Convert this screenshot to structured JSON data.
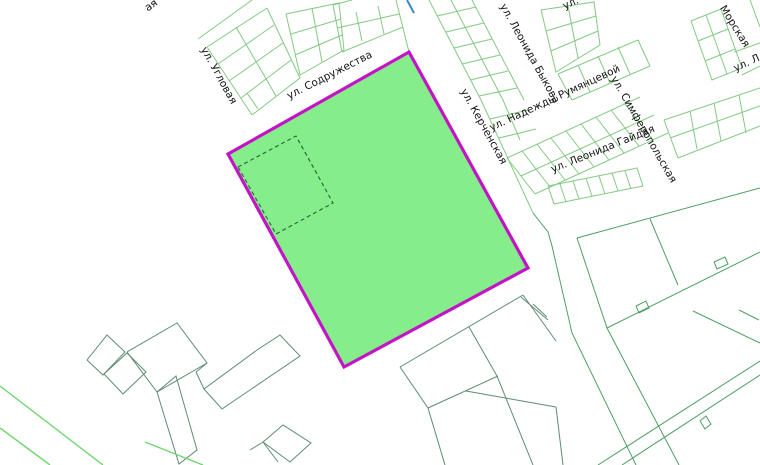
{
  "map": {
    "canvas": {
      "width": 760,
      "height": 465,
      "background": "#ffffff"
    },
    "colors": {
      "grid_light_green": "#83ca83",
      "parcel_mid_green": "#4d9f63",
      "outline_gray_green": "#5d8c72",
      "bright_green": "#6fd66f",
      "water_blue": "#3a86c8",
      "selected_fill": "#85ee8b",
      "selected_border": "#c412c6",
      "dashed_boundary": "#2d6a3f",
      "label_color": "#141414"
    },
    "selected_parcel": {
      "points": "228,154 409,52 528,268 344,367",
      "fill": "#85ee8b",
      "stroke": "#c412c6",
      "stroke_width": 3.2
    },
    "dashed_square": {
      "points": "238,167 296,136 333,203 276,234 238,167",
      "stroke": "#2d6a3f",
      "dash": "4,3"
    },
    "labels": [
      {
        "text": "ая",
        "x": 153,
        "y": 8,
        "rot": -35,
        "size": 10.5
      },
      {
        "text": "ул. Угловая",
        "x": 216,
        "y": 77,
        "rot": 61,
        "size": 10.5
      },
      {
        "text": "ул. Содружества",
        "x": 331,
        "y": 78,
        "rot": -27,
        "size": 10.5
      },
      {
        "text": "ул. Керченская",
        "x": 481,
        "y": 128,
        "rot": 61,
        "size": 10.5
      },
      {
        "text": "ул. Леонида Быкова",
        "x": 527,
        "y": 55,
        "rot": 61,
        "size": 10.5
      },
      {
        "text": "ул. Надежды Румянцевой",
        "x": 556,
        "y": 101,
        "rot": -25,
        "size": 10.5
      },
      {
        "text": "ул. Симферопольская",
        "x": 641,
        "y": 131,
        "rot": 60,
        "size": 10.5
      },
      {
        "text": "ул. Леонида Гайдая",
        "x": 604,
        "y": 152,
        "rot": -22,
        "size": 10.5
      },
      {
        "text": "Морская",
        "x": 732,
        "y": 28,
        "rot": 58,
        "size": 10.5
      },
      {
        "text": "ул. Л",
        "x": 748,
        "y": 66,
        "rot": -25,
        "size": 10.5
      },
      {
        "text": "ул.",
        "x": 572,
        "y": 6,
        "rot": -25,
        "size": 10.5
      }
    ],
    "layers": [
      {
        "name": "grid-light",
        "color": "#83ca83",
        "width": 1,
        "polylines": [
          "207,47 267,8",
          "207,47 252,115",
          "252,115 300,78",
          "267,8 300,78",
          "218,64 274,25",
          "229,81 283,43",
          "241,98 291,60",
          "236,27 276,96",
          "198,39 252,0",
          "247,93 258,109",
          "286,14 339,3 344,50 300,75 286,14",
          "312,8 322,62",
          "291,34 341,19",
          "295,55 342,35",
          "333,5 342,52",
          "342,52 403,27",
          "333,5 352,0",
          "337,28 399,14",
          "356,12 362,41",
          "378,6 384,34",
          "396,0 409,52",
          "429,0 481,100 533,213",
          "451,0 503,100 520,140",
          "472,0 524,100",
          "437,16 476,7",
          "446,32 484,23",
          "454,48 492,39",
          "462,64 500,55",
          "470,80 508,71",
          "479,96 517,88",
          "490,119 528,110",
          "499,138 536,129",
          "541,10 594,2 600,45 556,72 541,10",
          "568,6 578,58",
          "546,31 596,16",
          "551,51 598,31",
          "558,74 638,40",
          "572,100 650,66",
          "558,74 572,100",
          "638,40 650,66",
          "578,65 590,92",
          "598,56 610,83",
          "618,47 630,74",
          "691,21 721,9 742,68 712,80 691,21",
          "706,15 727,74",
          "698,41 728,29",
          "705,61 735,49",
          "750,0 760,27",
          "734,52 760,43",
          "742,75 760,66",
          "664,120 760,88",
          "670,138 760,106",
          "678,158 760,126",
          "664,120 678,158",
          "690,111 697,149",
          "714,103 721,141",
          "739,95 746,133",
          "507,158 640,97",
          "521,176 654,115",
          "535,194 668,133",
          "507,158 535,194",
          "522,151 550,187",
          "537,144 565,180",
          "551,138 579,174",
          "566,131 594,167",
          "581,124 609,160",
          "596,117 624,153",
          "611,110 639,146",
          "625,104 653,140",
          "548,186 637,168 643,186 554,204 548,186",
          "560,184 566,202",
          "573,181 579,199",
          "586,178 592,196",
          "599,176 605,194",
          "612,173 618,191",
          "625,171 631,189"
        ]
      },
      {
        "name": "parcel-mid",
        "color": "#4d9f63",
        "width": 1,
        "polylines": [
          "577,238 760,188",
          "577,238 607,328 679,465",
          "650,219 678,285",
          "607,328 760,252",
          "533,213 548,232 552,246 572,333 636,465",
          "693,311 760,343",
          "739,310 759,320",
          "598,465 760,361",
          "622,465 760,375",
          "700,421 706,416 711,424 705,429 700,421",
          "636,306 646,301 649,308 639,313 636,306",
          "714,262 725,257 728,264 717,269 714,262"
        ]
      },
      {
        "name": "outline-dark",
        "color": "#5d8c72",
        "width": 1,
        "polylines": [
          "400,367 523,295",
          "523,295 556,341",
          "400,367 428,408",
          "428,408 498,376",
          "469,327 497,376",
          "428,408 445,465",
          "466,391 556,407",
          "497,376 533,465",
          "556,407 563,465",
          "521,297 548,320",
          "533,304 547,317",
          "87,360 107,335 125,352 103,375 87,360",
          "104,374 127,353 146,372 123,394 104,374",
          "127,352 177,323 207,363 157,392 127,352",
          "157,392 176,376 197,450 179,464 157,392",
          "204,389 257,350 280,335 300,356 222,409 204,389",
          "196,372 204,389",
          "207,363 196,372",
          "263,442 283,425 311,443 290,462 263,442",
          "250,450 263,442 278,462"
        ]
      },
      {
        "name": "bright-lines",
        "color": "#6fd66f",
        "width": 1.4,
        "polylines": [
          "0,386 103,465",
          "0,428 50,465",
          "145,442 203,465"
        ]
      },
      {
        "name": "water-blue",
        "color": "#3a86c8",
        "width": 2,
        "polylines": [
          "407,0 414,13"
        ]
      }
    ]
  }
}
